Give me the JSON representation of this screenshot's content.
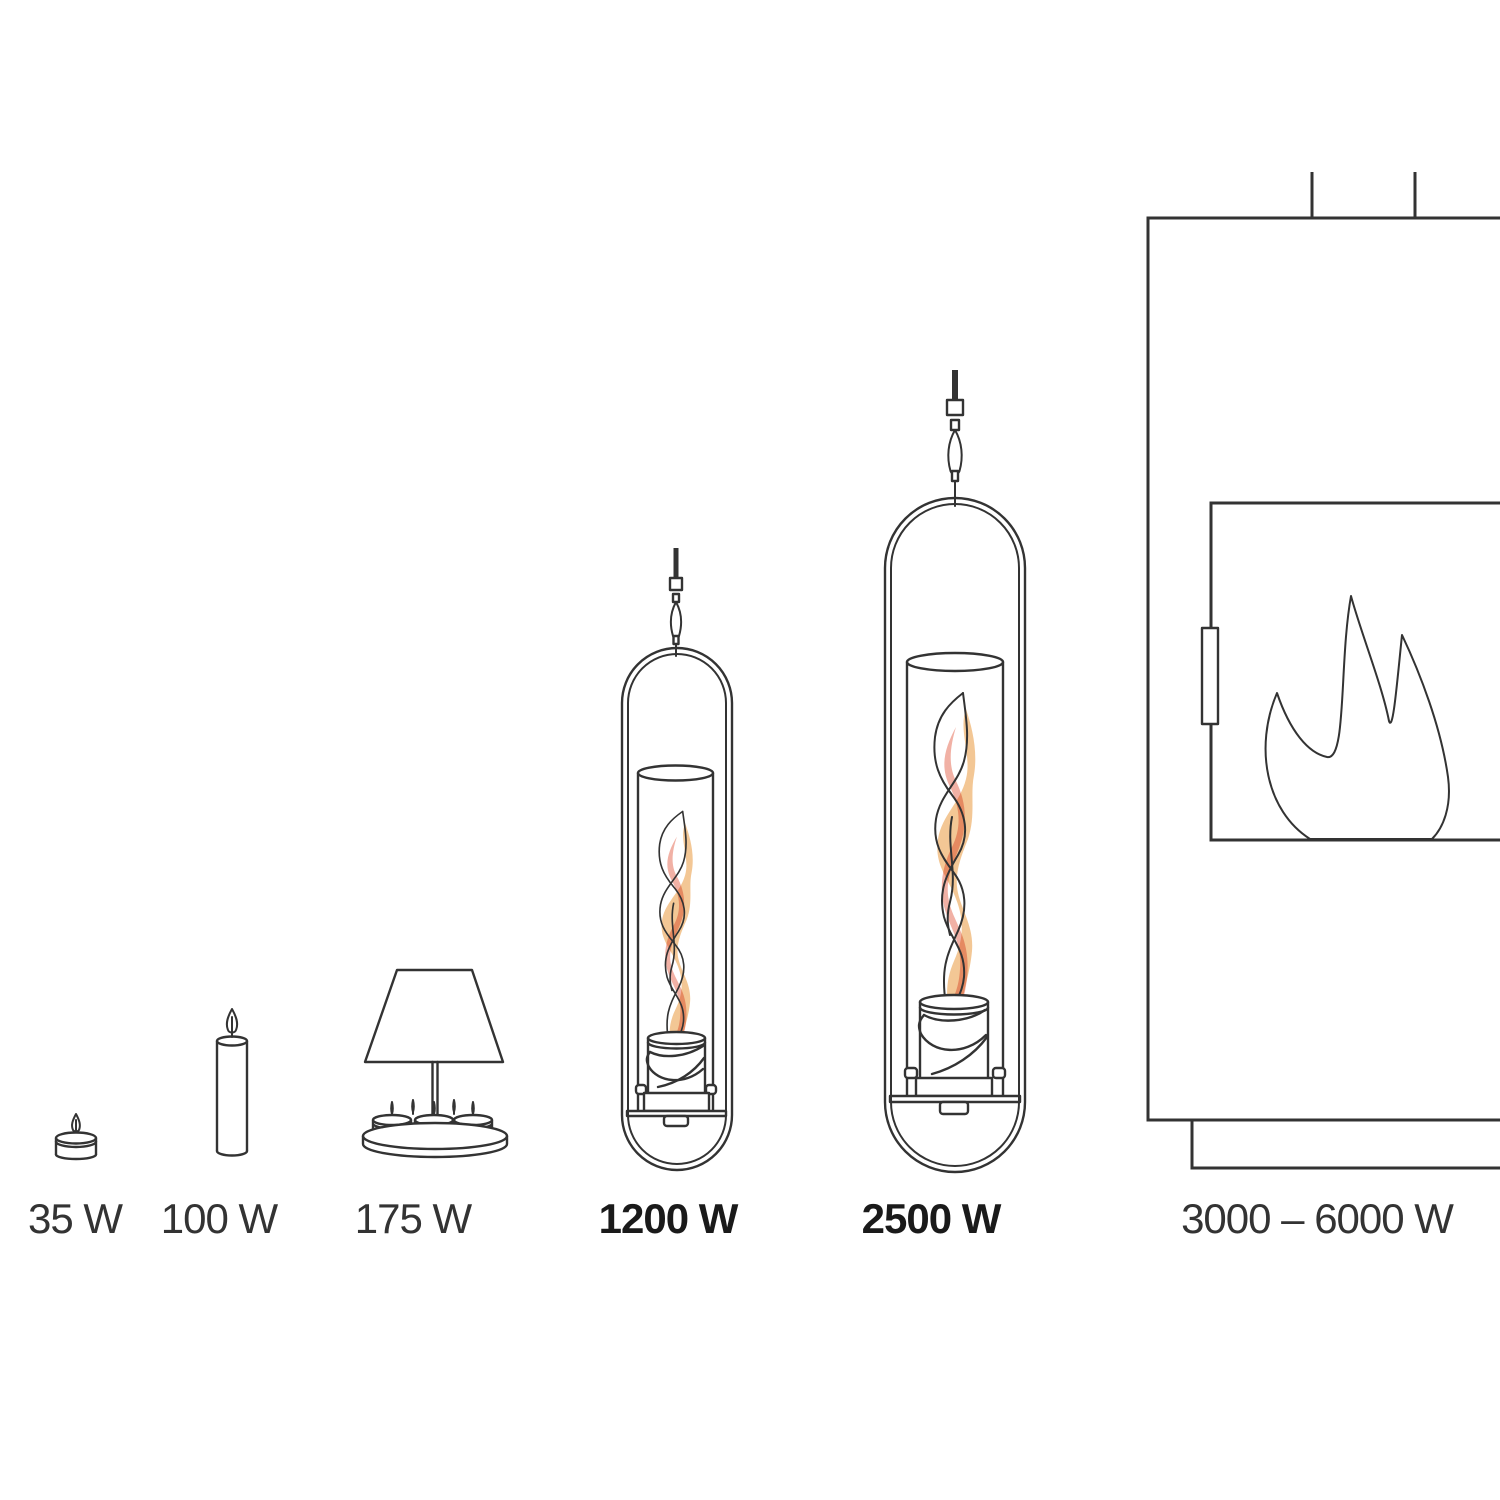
{
  "colors": {
    "line_color": "#333333",
    "bold_text_color": "#1a1a1a",
    "flame_orange": "#f2c189",
    "flame_salmon": "#efa89b",
    "background": "#ffffff"
  },
  "items": [
    {
      "icon": "tealight-icon",
      "label": "35 W",
      "emphasis": false
    },
    {
      "icon": "candle-icon",
      "label": "100 W",
      "emphasis": false
    },
    {
      "icon": "tealight-lamp-icon",
      "label": "175 W",
      "emphasis": false
    },
    {
      "icon": "hanging-fire-lantern-small-icon",
      "label": "1200 W",
      "emphasis": true
    },
    {
      "icon": "hanging-fire-lantern-large-icon",
      "label": "2500 W",
      "emphasis": true
    },
    {
      "icon": "wood-stove-icon",
      "label": "3000 – 6000 W",
      "emphasis": false
    }
  ]
}
